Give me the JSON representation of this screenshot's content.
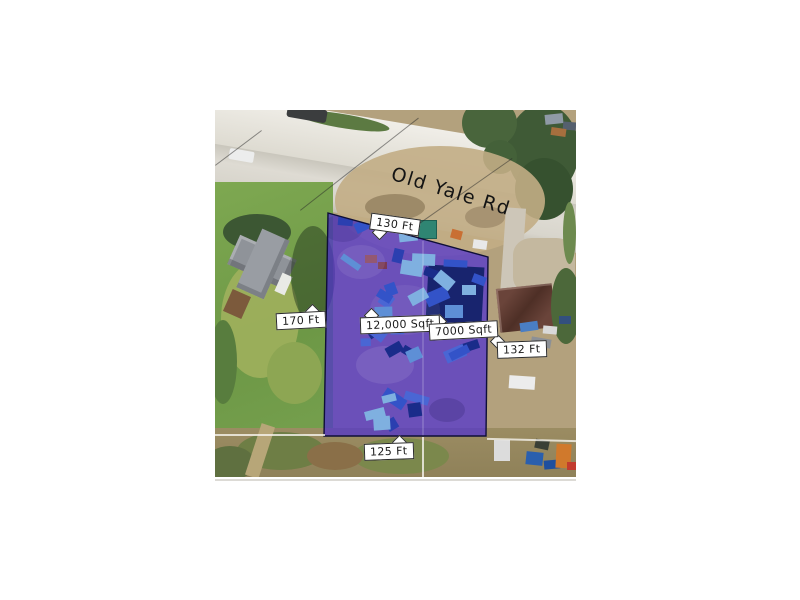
{
  "map": {
    "road_label": "Old Yale Rd",
    "dimensions": {
      "top": "130 Ft",
      "left": "170 Ft",
      "right": "132 Ft",
      "bottom": "125 Ft"
    },
    "areas": {
      "main": "12,000 Sqft",
      "secondary": "7000 Sqft"
    },
    "parcel_style": {
      "overlay_fill": "#4f31d0",
      "overlay_opacity": 0.72,
      "outline": "#0e0e38",
      "divider": "rgba(255,255,255,0.32)",
      "vehicle_palette": [
        "#4a66d4",
        "#5e8fd6",
        "#2b3fb0",
        "#7fb0e0",
        "#3353c8",
        "#1a2c8a"
      ],
      "building_navy": "#18246e"
    },
    "label_style": {
      "background": "#ffffff",
      "border": "#2b2b2b",
      "text": "#1b1b1b"
    }
  }
}
